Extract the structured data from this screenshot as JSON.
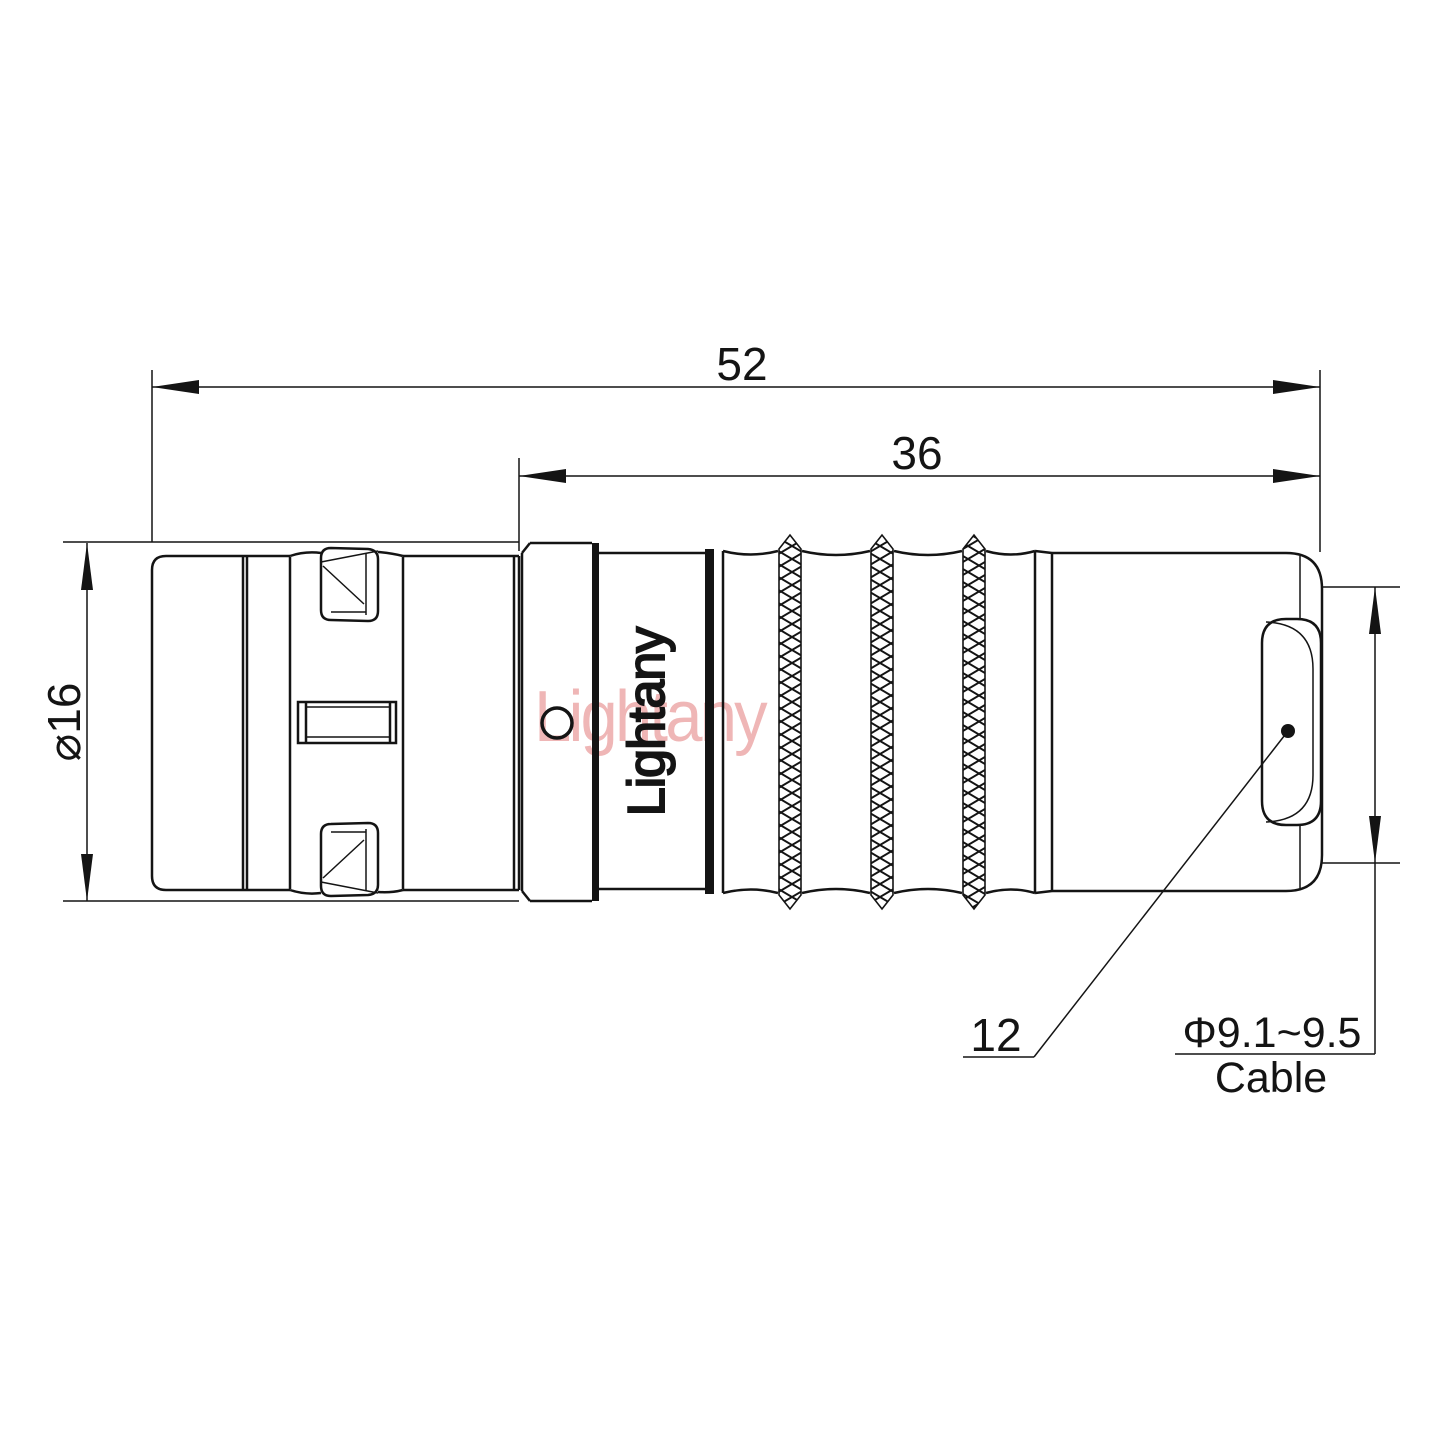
{
  "canvas": {
    "background": "#ffffff",
    "line_color": "#141414"
  },
  "watermark": {
    "text": "Lightany",
    "color": "#efb6b6"
  },
  "connector": {
    "engraving": "Lightany"
  },
  "dimensions": {
    "overall_length": {
      "value": "52"
    },
    "rear_length": {
      "value": "36"
    },
    "body_diameter": {
      "value": "⌀16"
    },
    "sleeve_diameter": {
      "value": "12"
    },
    "cable": {
      "range": "Φ9.1~9.5",
      "label": "Cable"
    }
  }
}
